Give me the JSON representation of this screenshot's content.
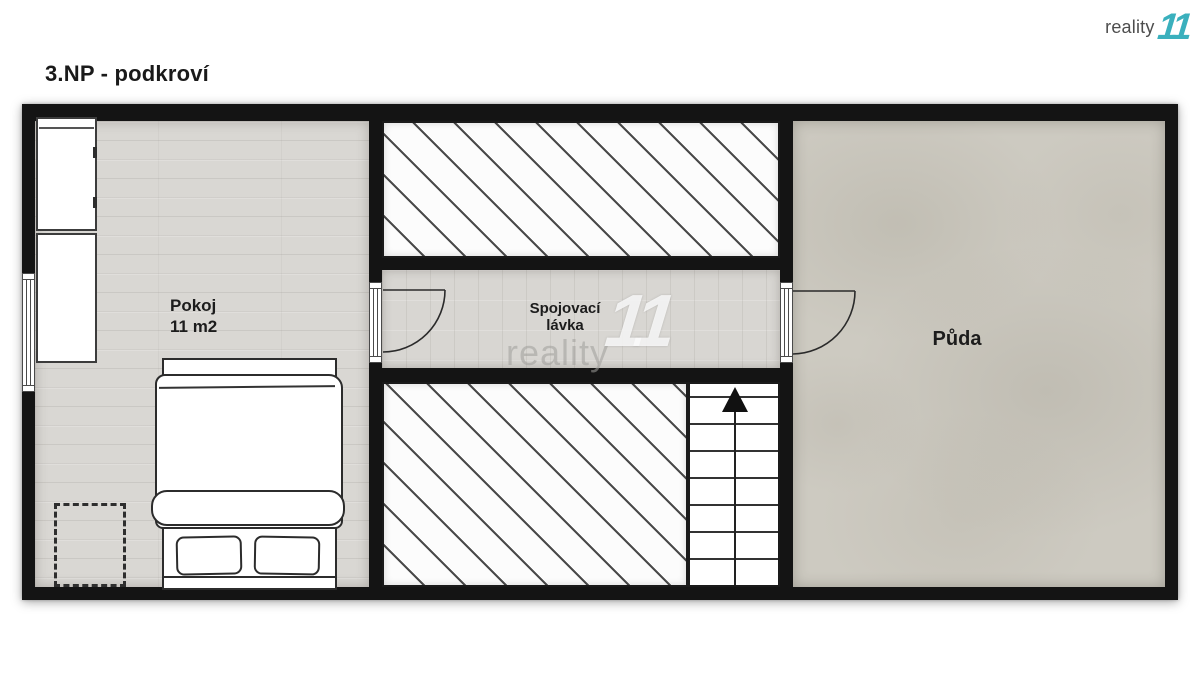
{
  "page_title": "3.NP - podkroví",
  "logo": {
    "brand": "reality",
    "mark": "11",
    "brand_color": "#4d4d4d",
    "mark_color": "#3ab0bd"
  },
  "watermark": {
    "brand": "reality",
    "mark": "11"
  },
  "rooms": {
    "pokoj": {
      "name": "Pokoj",
      "area": "11 m2"
    },
    "spojovaci_lavka": {
      "name_line1": "Spojovací",
      "name_line2": "lávka"
    },
    "puda": {
      "name": "Půda"
    }
  },
  "colors": {
    "wall": "#141414",
    "wood_floor": "#d9d7d3",
    "corridor_floor": "#d8d6d2",
    "concrete_floor": "#cdcac1",
    "hatch_line": "#4a4a4a",
    "brand_teal": "#3ab0bd"
  }
}
